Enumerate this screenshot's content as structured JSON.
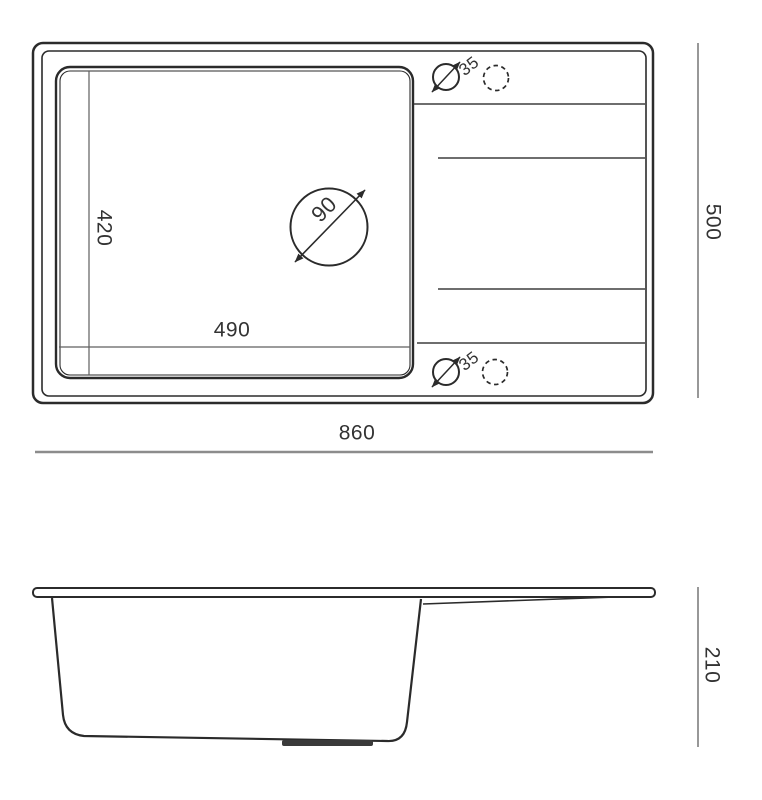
{
  "top_view": {
    "overall_width": "860",
    "overall_depth": "500",
    "bowl_inner_width": "490",
    "bowl_inner_depth": "420",
    "drain_hole_diameter": "90",
    "tap_holes": {
      "top_diameter": "35",
      "bottom_diameter": "35"
    }
  },
  "side_view": {
    "overall_height": "210"
  },
  "colors": {
    "outline": "#2b2b2b",
    "dimension_line": "#8c8c8c",
    "groove_line": "#3f3f3f",
    "label_text": "#333333",
    "background": "#ffffff"
  }
}
